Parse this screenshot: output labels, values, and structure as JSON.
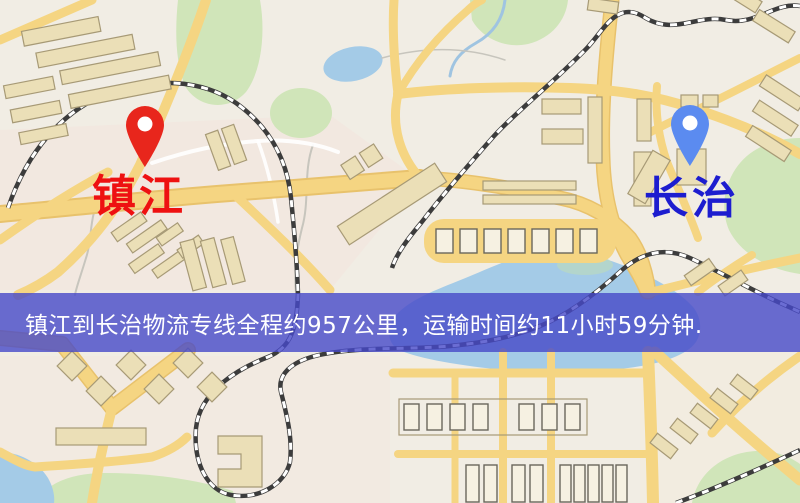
{
  "banner": {
    "text": "镇江到长治物流专线全程约957公里，运输时间约11小时59分钟.",
    "background": "rgba(70,72,200,0.8)",
    "text_color": "#ffffff"
  },
  "markers": {
    "origin": {
      "name": "镇江",
      "pin_color": "#e8261c",
      "pin_hole_color": "#ffffff",
      "label_color": "#ee1111"
    },
    "destination": {
      "name": "长治",
      "pin_color": "#5b8bf0",
      "pin_hole_color": "#ffffff",
      "label_color": "#1d1dcf"
    }
  },
  "route_summary": {
    "origin": "镇江",
    "destination": "长治",
    "distance_text": "约957公里",
    "duration_text": "约11小时59分钟"
  },
  "map_palette": {
    "background": "#f1ede4",
    "road": "#f6d57e",
    "road_edge": "#eac268",
    "minor_road": "#ffffff",
    "water": "#a3cbe8",
    "park": "#cfe5b7",
    "building_fill": "#ecdfb5",
    "building_stroke": "#a89a74",
    "rail_dark": "#3c3c3c",
    "rail_light": "#ffffff",
    "stream": "#c7c5bd"
  }
}
